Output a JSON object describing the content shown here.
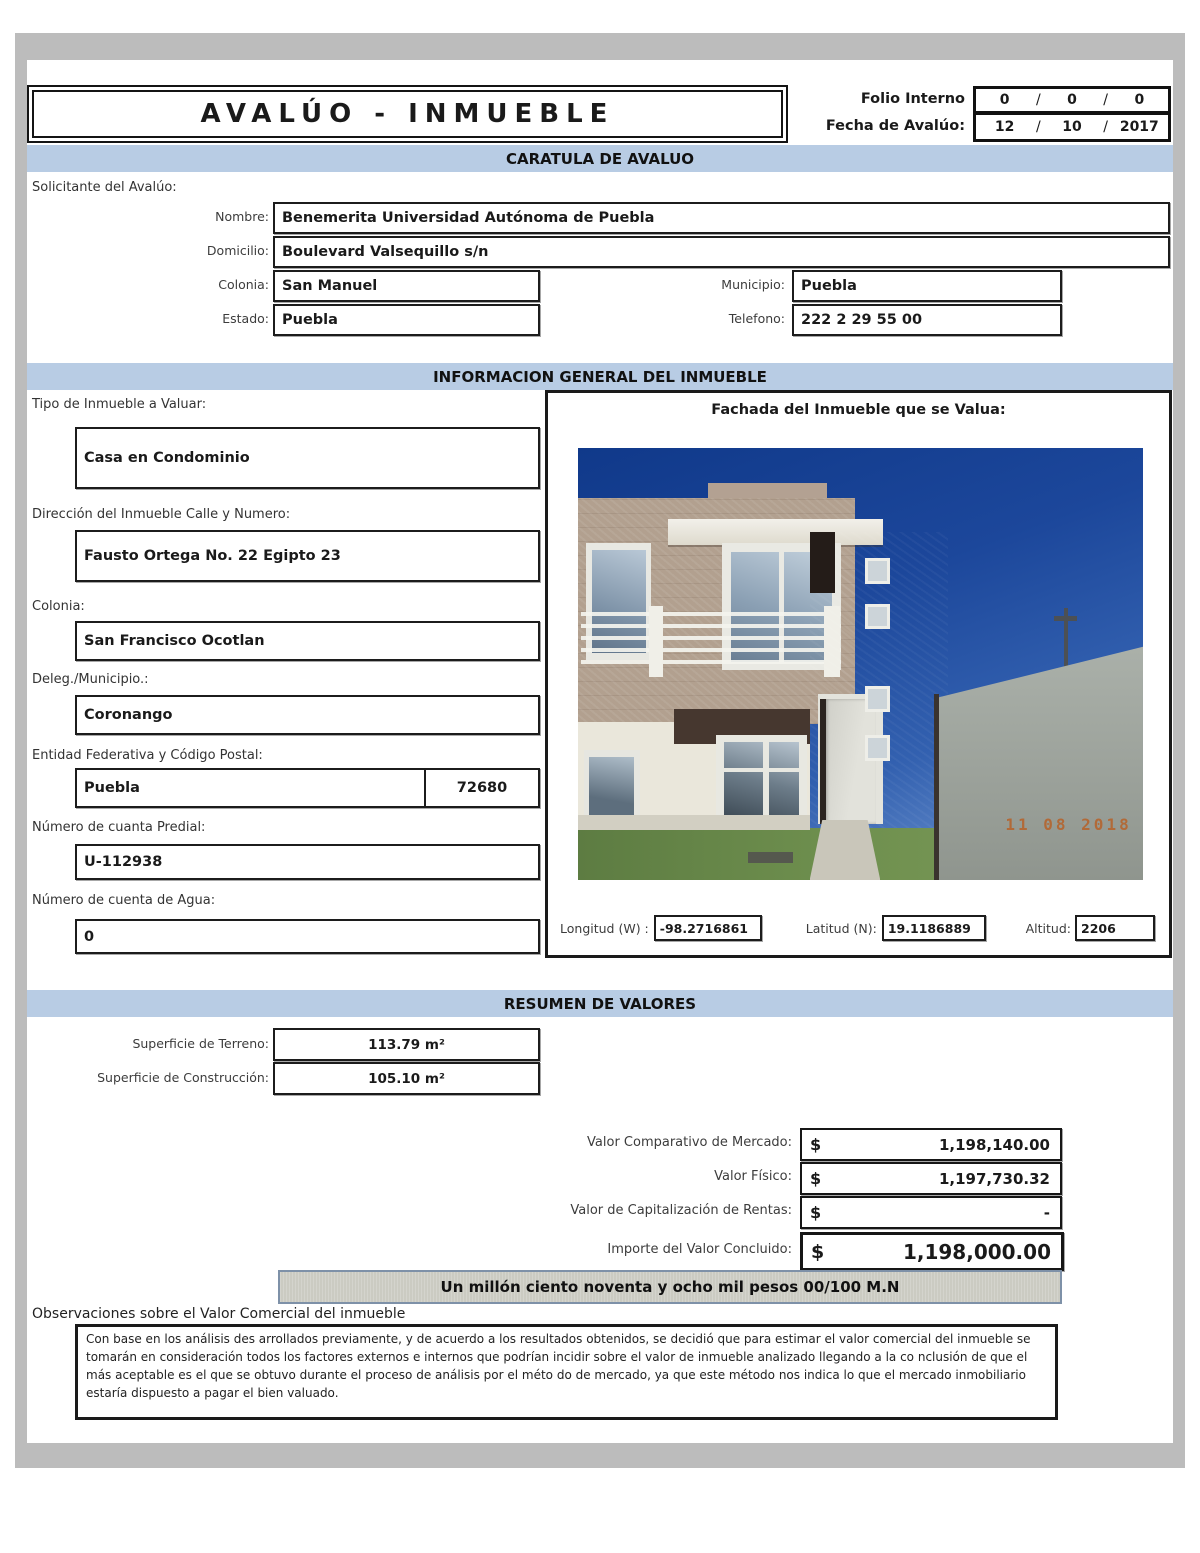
{
  "header": {
    "title": "AVALÚO - INMUEBLE",
    "folio_label": "Folio Interno",
    "folio_values": [
      "0",
      "0",
      "0"
    ],
    "date_label": "Fecha de Avalúo:",
    "date_values": [
      "12",
      "10",
      "2017"
    ],
    "slash": "/"
  },
  "sections": {
    "caratula": "CARATULA DE AVALUO",
    "info_general": "INFORMACION GENERAL DEL INMUEBLE",
    "resumen": "RESUMEN DE VALORES"
  },
  "solicitante": {
    "heading": "Solicitante del Avalúo:",
    "nombre_label": "Nombre:",
    "nombre": "Benemerita Universidad Autónoma de Puebla",
    "domicilio_label": "Domicilio:",
    "domicilio": "Boulevard Valsequillo s/n",
    "colonia_label": "Colonia:",
    "colonia": "San Manuel",
    "municipio_label": "Municipio:",
    "municipio": "Puebla",
    "estado_label": "Estado:",
    "estado": "Puebla",
    "telefono_label": "Telefono:",
    "telefono": "222 2 29 55 00"
  },
  "inmueble": {
    "tipo_label": "Tipo de Inmueble a Valuar:",
    "tipo": "Casa en Condominio",
    "direccion_label": "Dirección del Inmueble Calle y Numero:",
    "direccion": "Fausto Ortega No. 22 Egipto 23",
    "colonia_label": "Colonia:",
    "colonia": "San Francisco Ocotlan",
    "municipio_label": "Deleg./Municipio.:",
    "municipio": "Coronango",
    "entidad_label": "Entidad Federativa y Código Postal:",
    "entidad": "Puebla",
    "codigo_postal": "72680",
    "predial_label": "Número de cuanta Predial:",
    "predial": "U-112938",
    "agua_label": "Número de cuenta de Agua:",
    "agua": "0"
  },
  "fachada": {
    "title": "Fachada del Inmueble que se Valua:",
    "date_stamp": "11 08 2018",
    "longitud_label": "Longitud (W) :",
    "longitud": "-98.2716861",
    "latitud_label": "Latitud (N):",
    "latitud": "19.1186889",
    "altitud_label": "Altitud:",
    "altitud": "2206"
  },
  "resumen_valores": {
    "terreno_label": "Superficie de Terreno:",
    "terreno": "113.79 m²",
    "construccion_label": "Superficie de Construcción:",
    "construccion": "105.10 m²",
    "rows": [
      {
        "label": "Valor Comparativo de Mercado:",
        "currency": "$",
        "amount": "1,198,140.00"
      },
      {
        "label": "Valor Físico:",
        "currency": "$",
        "amount": "1,197,730.32"
      },
      {
        "label": "Valor de Capitalización de Rentas:",
        "currency": "$",
        "amount": "-"
      },
      {
        "label": "Importe del Valor Concluido:",
        "currency": "$",
        "amount": "1,198,000.00"
      }
    ],
    "amount_words": "Un millón ciento noventa y ocho mil pesos 00/100 M.N"
  },
  "observaciones": {
    "heading": "Observaciones  sobre el Valor Comercial del inmueble",
    "text": "Con base en los análisis des arrollados previamente, y de acuerdo a los resultados obtenidos, se decidió que para estimar el valor comercial del inmueble se tomarán en consideración todos los factores externos e internos que podrían incidir sobre el valor de inmueble analizado llegando a la co nclusión de que el más aceptable es el que se obtuvo durante el proceso de análisis por el méto do de  mercado, ya que este método nos indica lo que el mercado inmobiliario estaría dispuesto a pagar el bien valuado."
  },
  "colors": {
    "section_band": "#b8cce4",
    "page_frame": "#bcbcbc",
    "amount_words_band": "#cbcbc2",
    "date_stamp": "#b5652f"
  }
}
